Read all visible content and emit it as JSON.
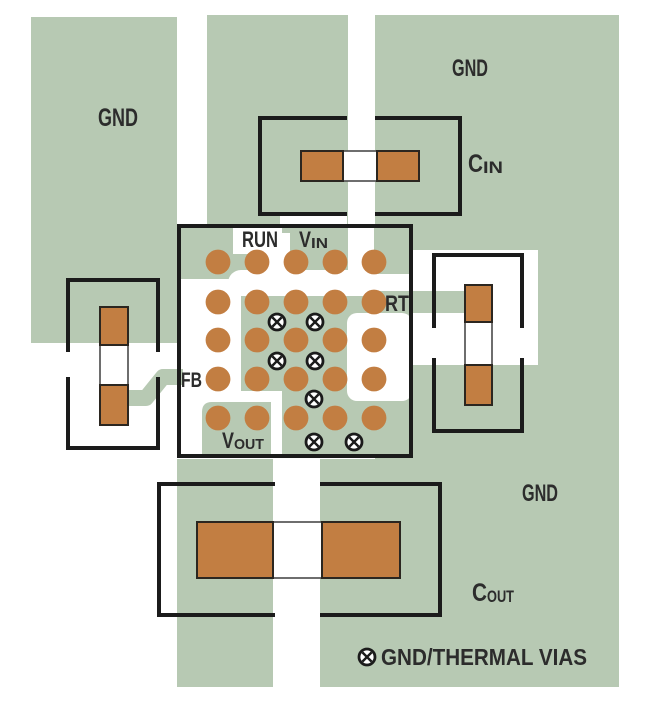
{
  "diagram_type": "pcb-layout",
  "colors": {
    "copper_pour": "#b7c9b3",
    "pad_copper": "#c27e42",
    "outline_ink": "#1b1b1b",
    "label_text": "#2c2c2c"
  },
  "labels": {
    "gnd_left": "GND",
    "gnd_top_right": "GND",
    "gnd_bottom_right": "GND",
    "run": "RUN",
    "vin_main": "V",
    "vin_sub": "IN",
    "rt": "RT",
    "fb": "FB",
    "vout_main": "V",
    "vout_sub": "OUT",
    "cin_main": "C",
    "cin_sub": "IN",
    "cout_main": "C",
    "cout_sub": "OUT"
  },
  "legend": {
    "via_symbol": "crossed-circle",
    "text": "GND/THERMAL VIAS"
  },
  "ic": {
    "pad_columns_x": [
      218,
      257,
      296,
      335,
      374
    ],
    "pad_rows_y": [
      262,
      302,
      340,
      379,
      418
    ],
    "pad_radius": 12.4,
    "vias": [
      [
        277,
        322
      ],
      [
        315,
        322
      ],
      [
        277,
        361
      ],
      [
        315,
        361
      ],
      [
        314,
        399
      ],
      [
        314,
        442
      ],
      [
        354,
        442
      ]
    ],
    "via_ring_radius": 8,
    "via_ring_stroke": 2.8,
    "via_cross_half": 4.6
  }
}
